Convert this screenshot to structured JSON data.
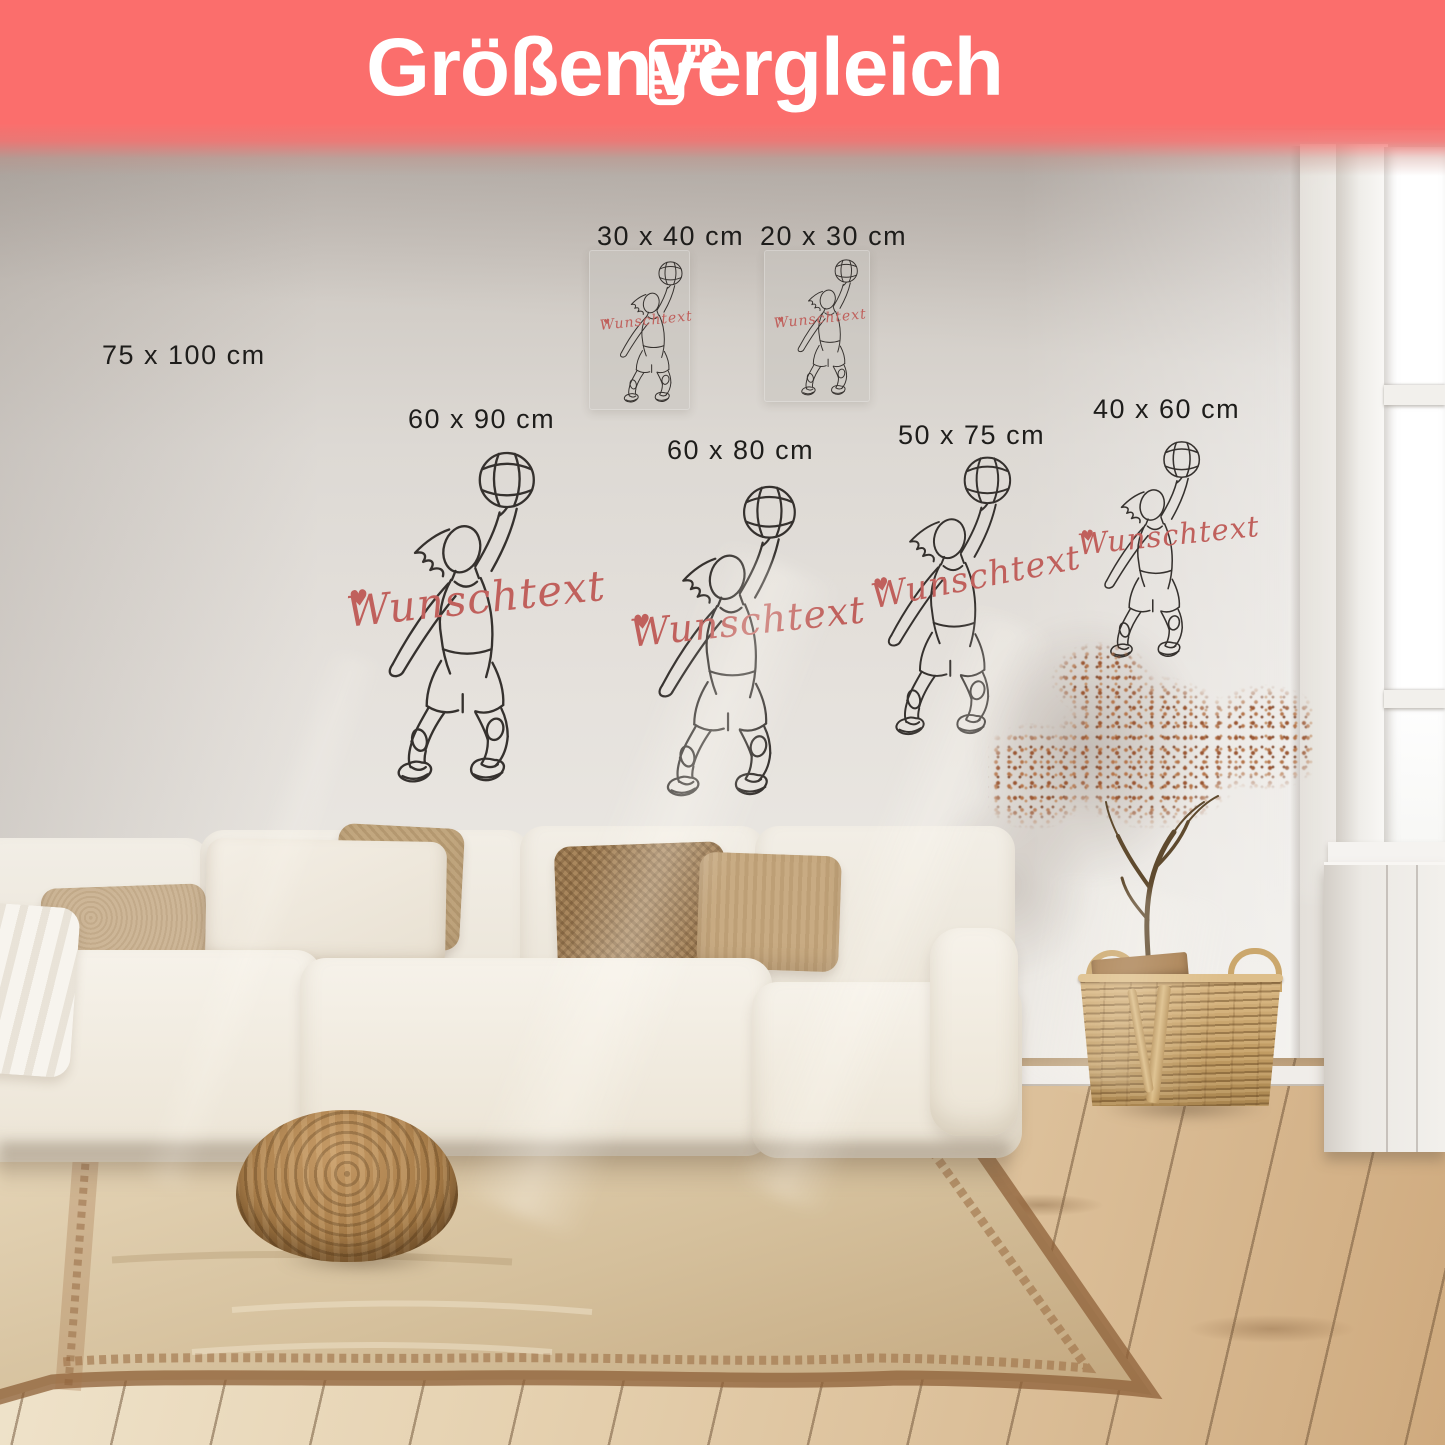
{
  "banner": {
    "title": "Größenvergleich",
    "icon": "folding-ruler-icon",
    "background": "#FB6E6C",
    "text_color": "#FFFFFF"
  },
  "sizes": [
    {
      "label": "75 x 100 cm"
    },
    {
      "label": "30 x 40 cm"
    },
    {
      "label": "20 x 30 cm"
    },
    {
      "label": "60 x 90 cm"
    },
    {
      "label": "60 x 80 cm"
    },
    {
      "label": "50 x 75 cm"
    },
    {
      "label": "40 x 60 cm"
    }
  ],
  "decal": {
    "subject": "basketball-player-one-line-art",
    "custom_text": "Wunschtext",
    "heart": "♥",
    "text_color": "#C0605C",
    "line_color": "#35312E"
  },
  "scene": {
    "label_color": "#1E1D1B",
    "wall_color": "#DFDBD6",
    "floor_wood_color": "#E0C9A6",
    "rug_color": "#D8C4A4",
    "rug_border_color": "#8E6038",
    "sofa_color": "#F2EDE4",
    "wicker_color": "#C9A672",
    "plant_foliage_color": "#9D5F3B"
  }
}
